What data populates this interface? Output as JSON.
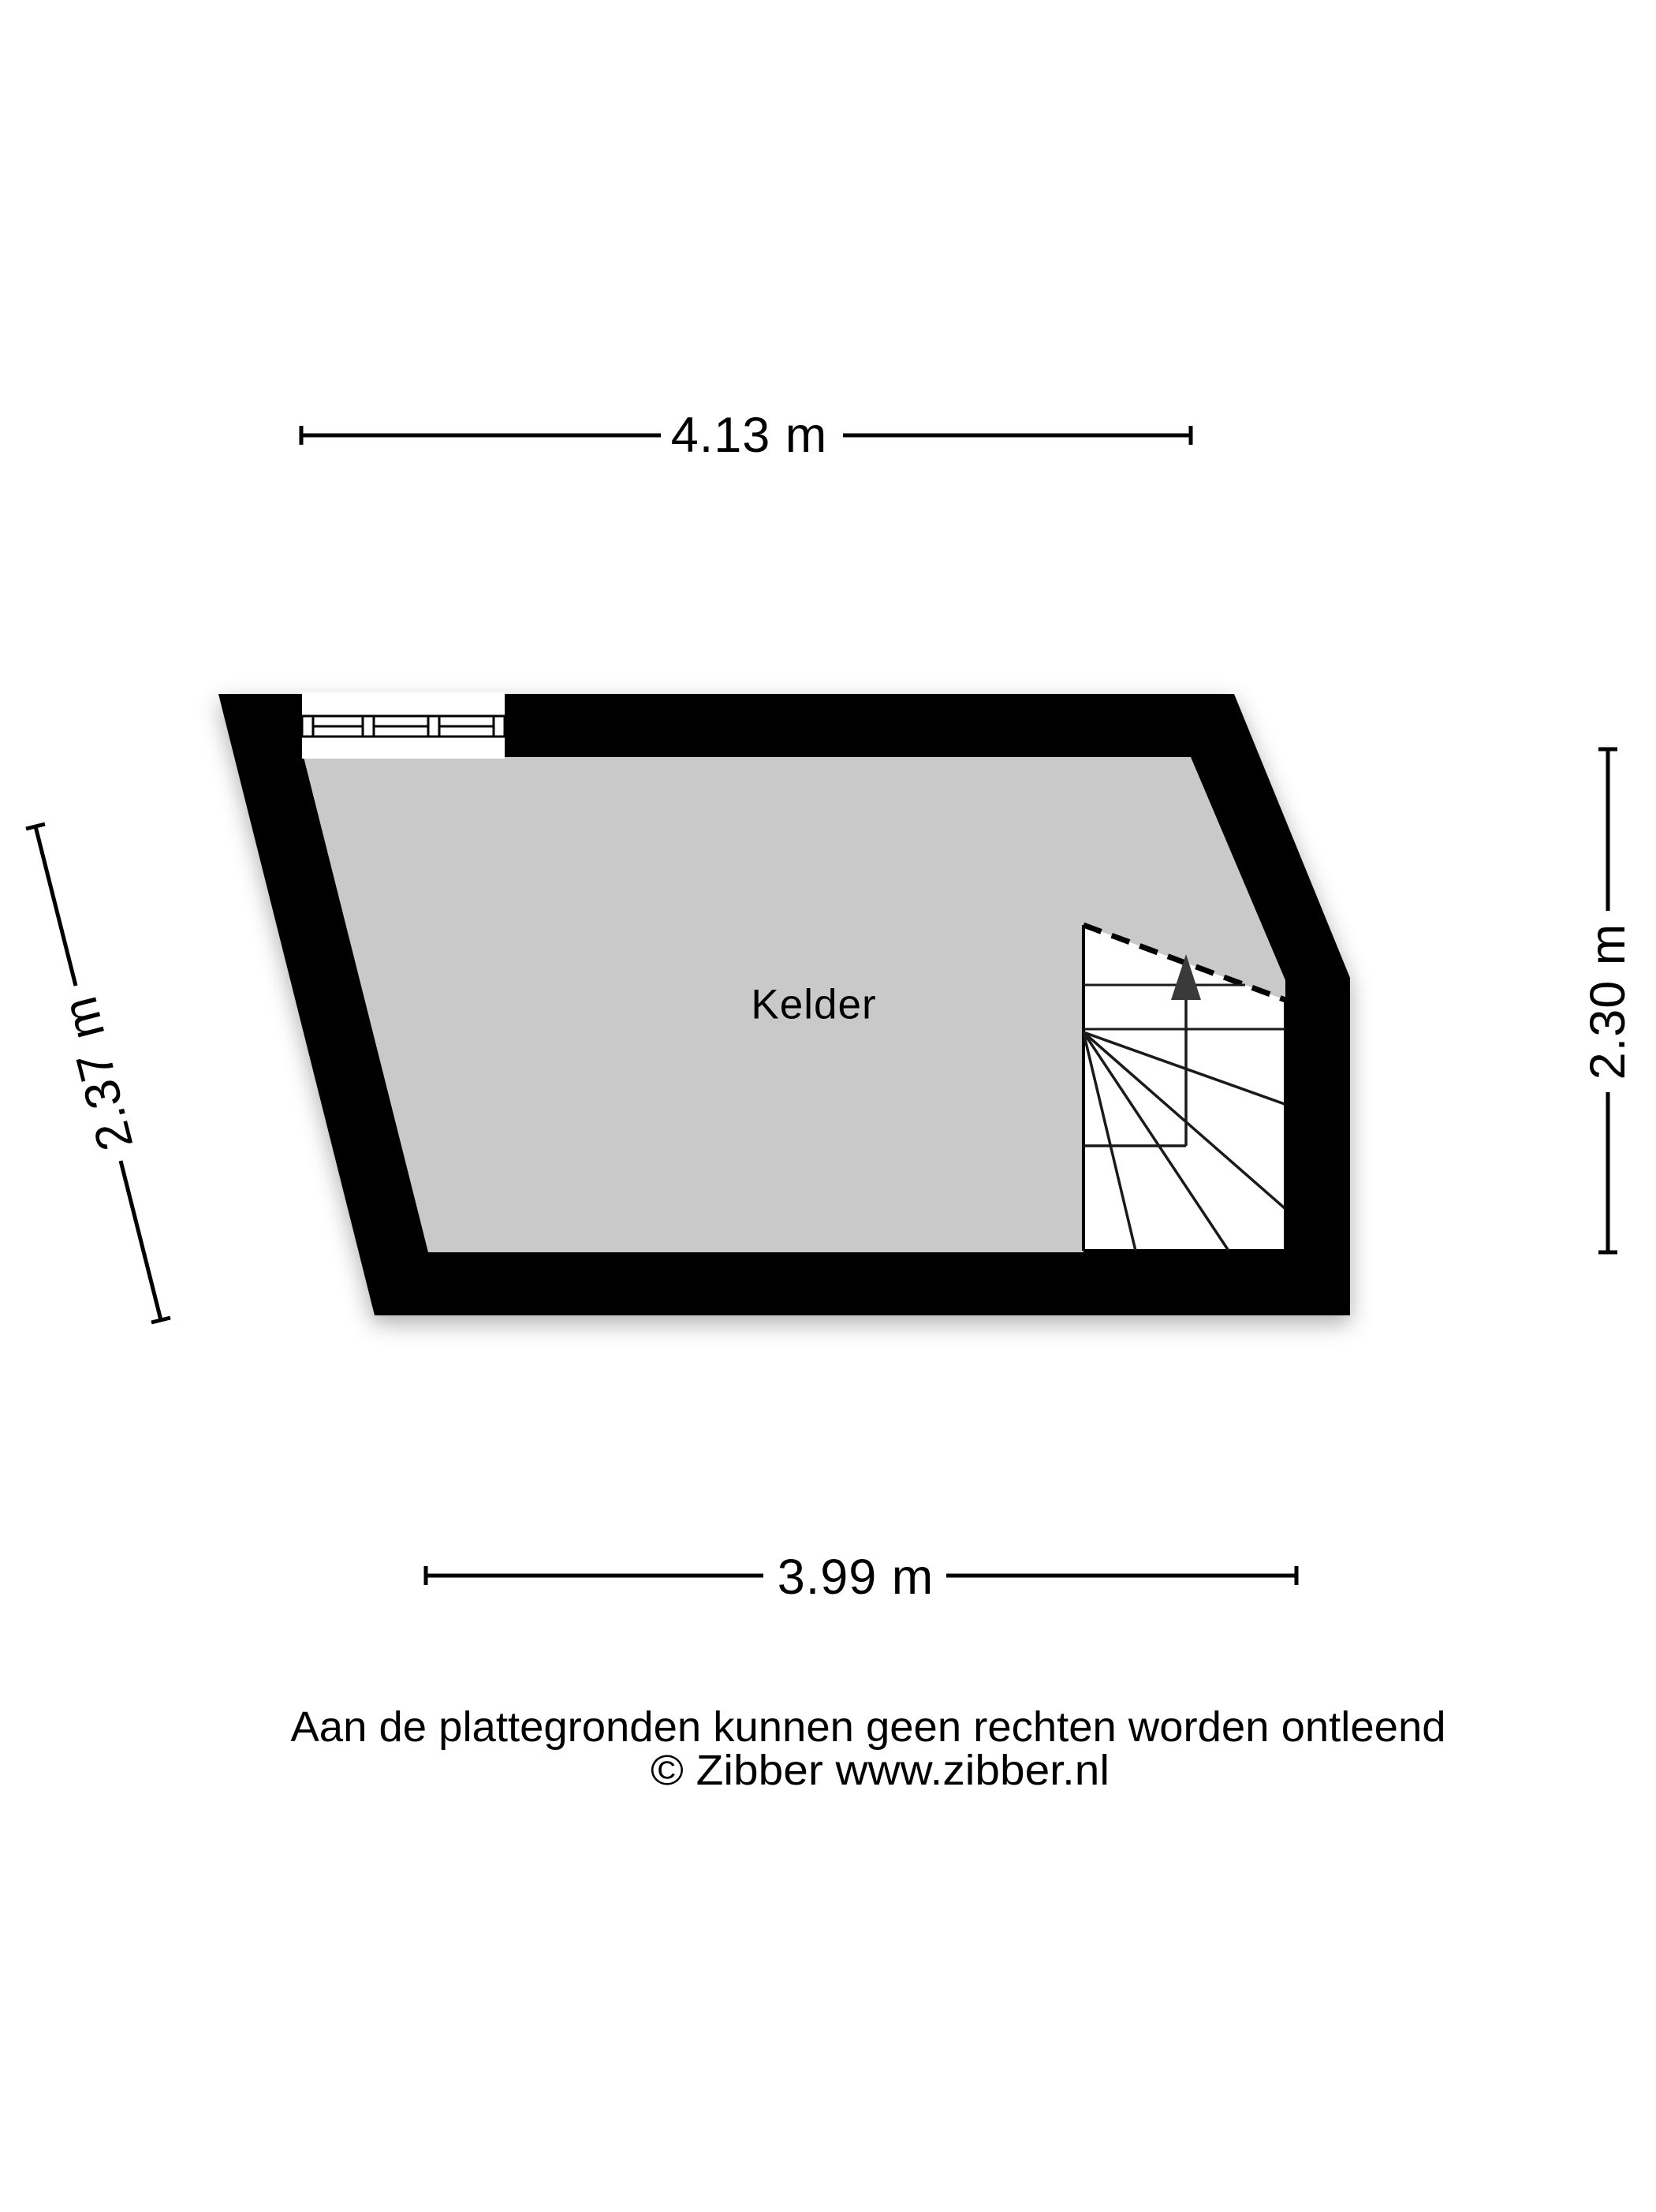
{
  "title": "Kelder plattegrond",
  "room": {
    "label": "Kelder"
  },
  "dimensions": {
    "top": "4.13 m",
    "left": "2.37 m",
    "right": "2.30 m",
    "bottom": "3.99 m"
  },
  "footer": {
    "line1": "Aan de plattegronden kunnen geen rechten worden ontleend",
    "line2": "© Zibber www.zibber.nl"
  },
  "colors": {
    "background": "#ffffff",
    "wall": "#000000",
    "floor": "#c9c9c9",
    "stair": "#ffffff",
    "arrow": "#3a3a3a"
  }
}
